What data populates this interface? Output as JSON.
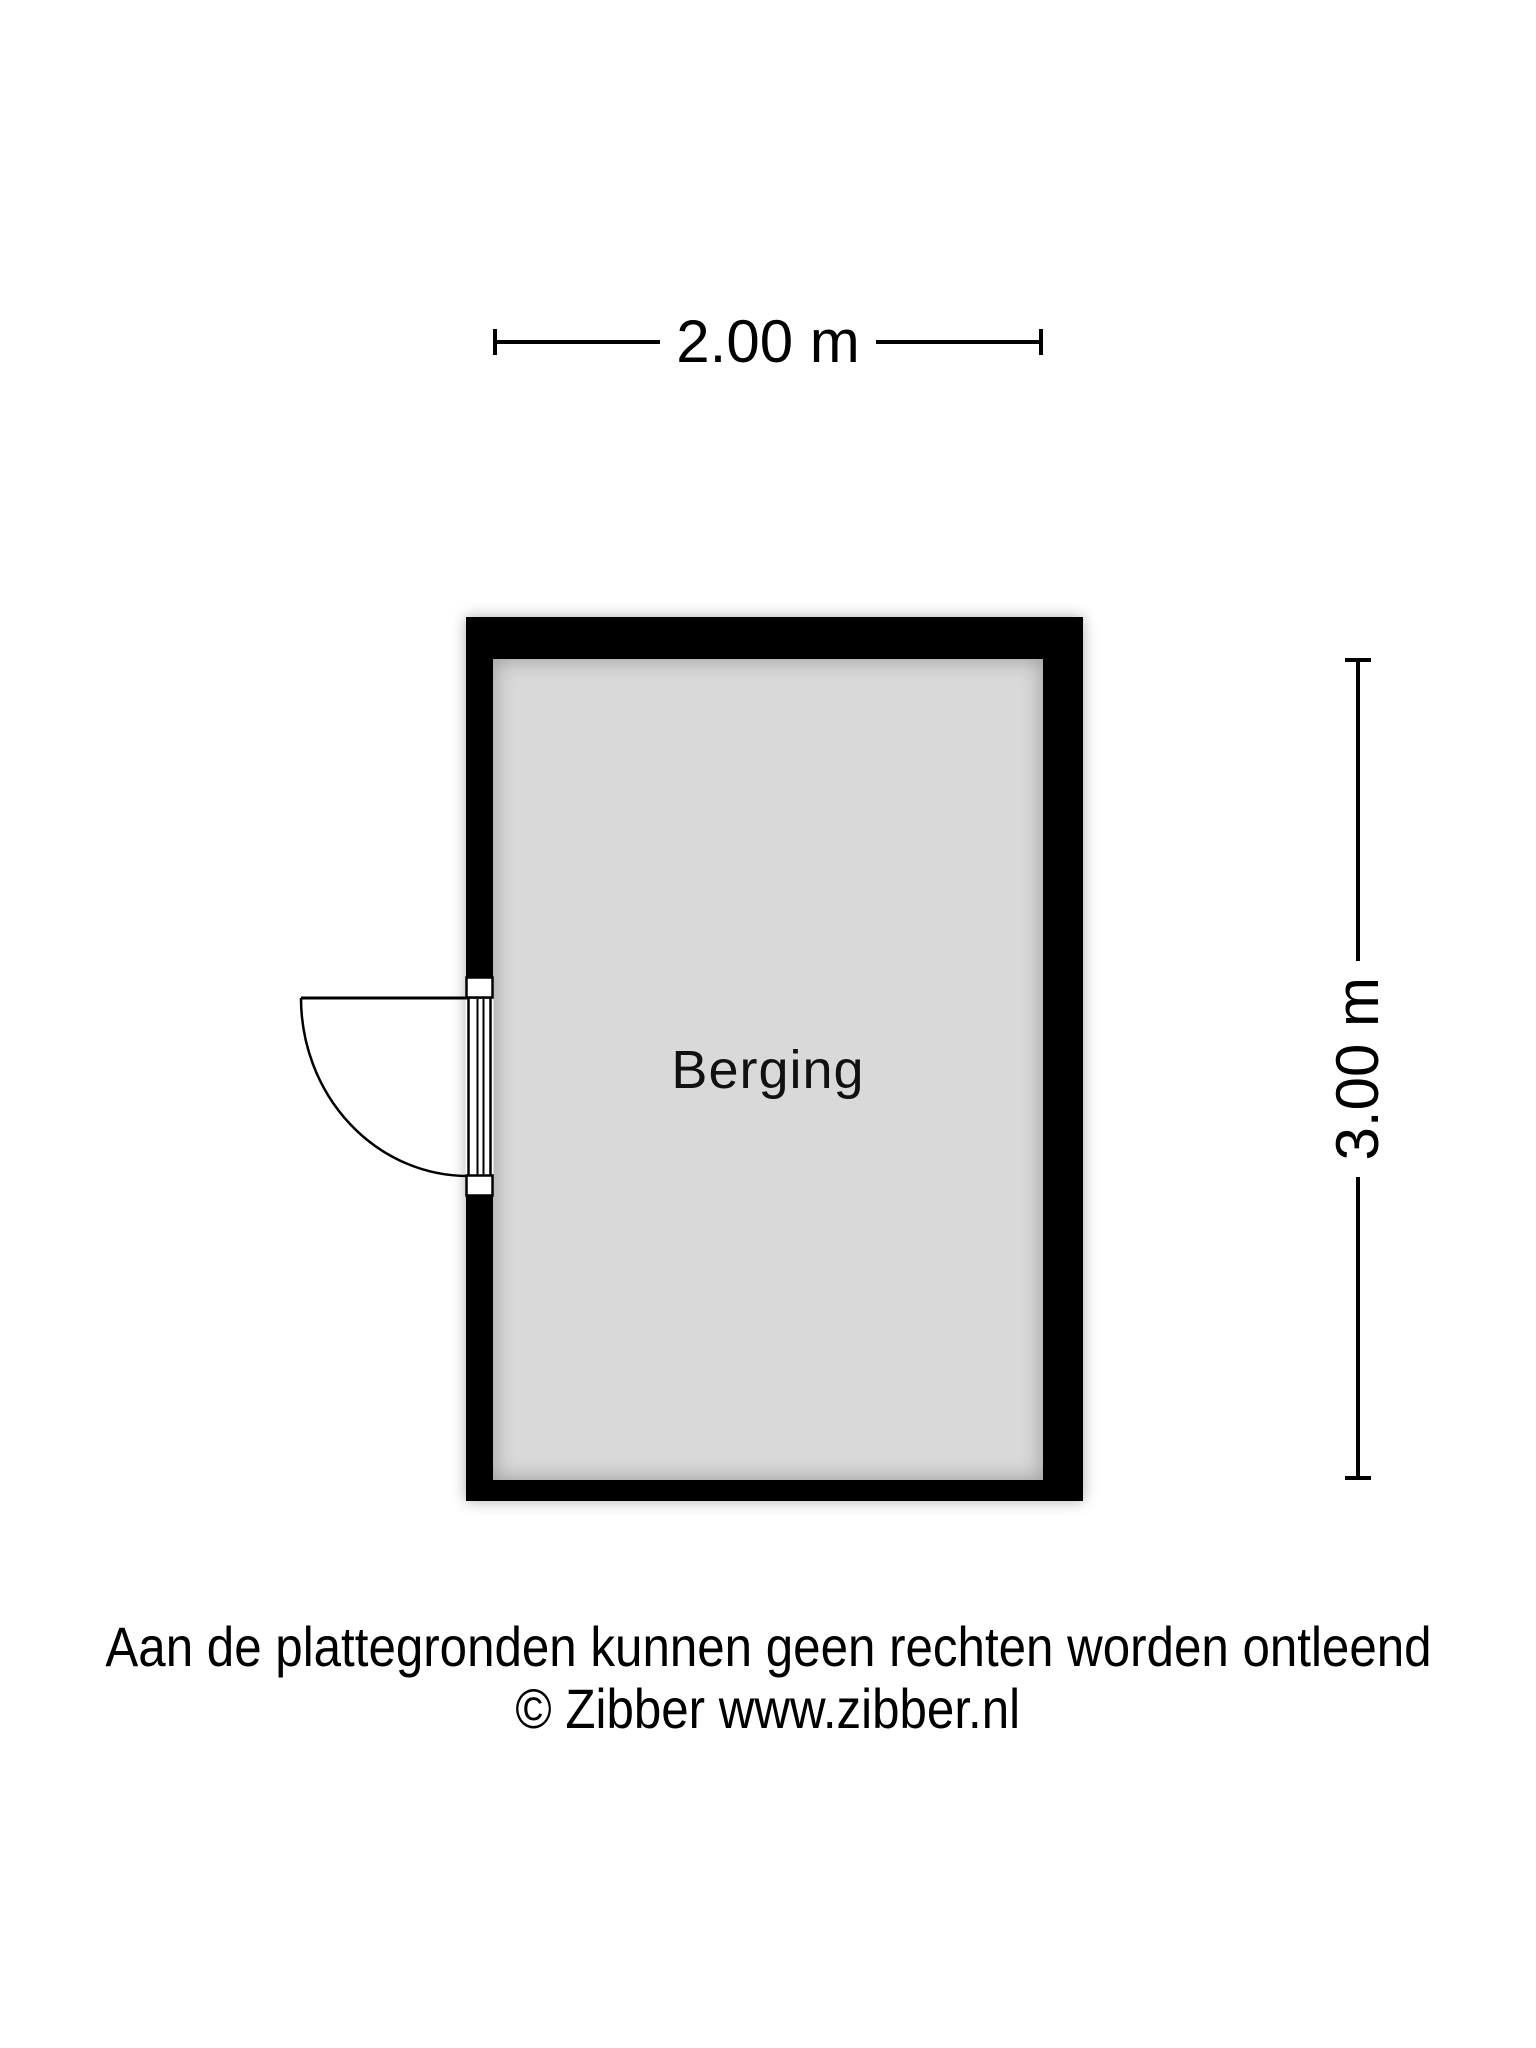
{
  "plan": {
    "room_label": "Berging",
    "dimensions": {
      "width_label": "2.00 m",
      "height_label": "3.00 m"
    }
  },
  "footer": {
    "disclaimer": "Aan de plattegronden kunnen geen rechten worden ontleend",
    "copyright": "© Zibber www.zibber.nl"
  },
  "colors": {
    "wall": "#000000",
    "floor": "#d9d9d9",
    "background": "#ffffff",
    "text": "#000000"
  }
}
